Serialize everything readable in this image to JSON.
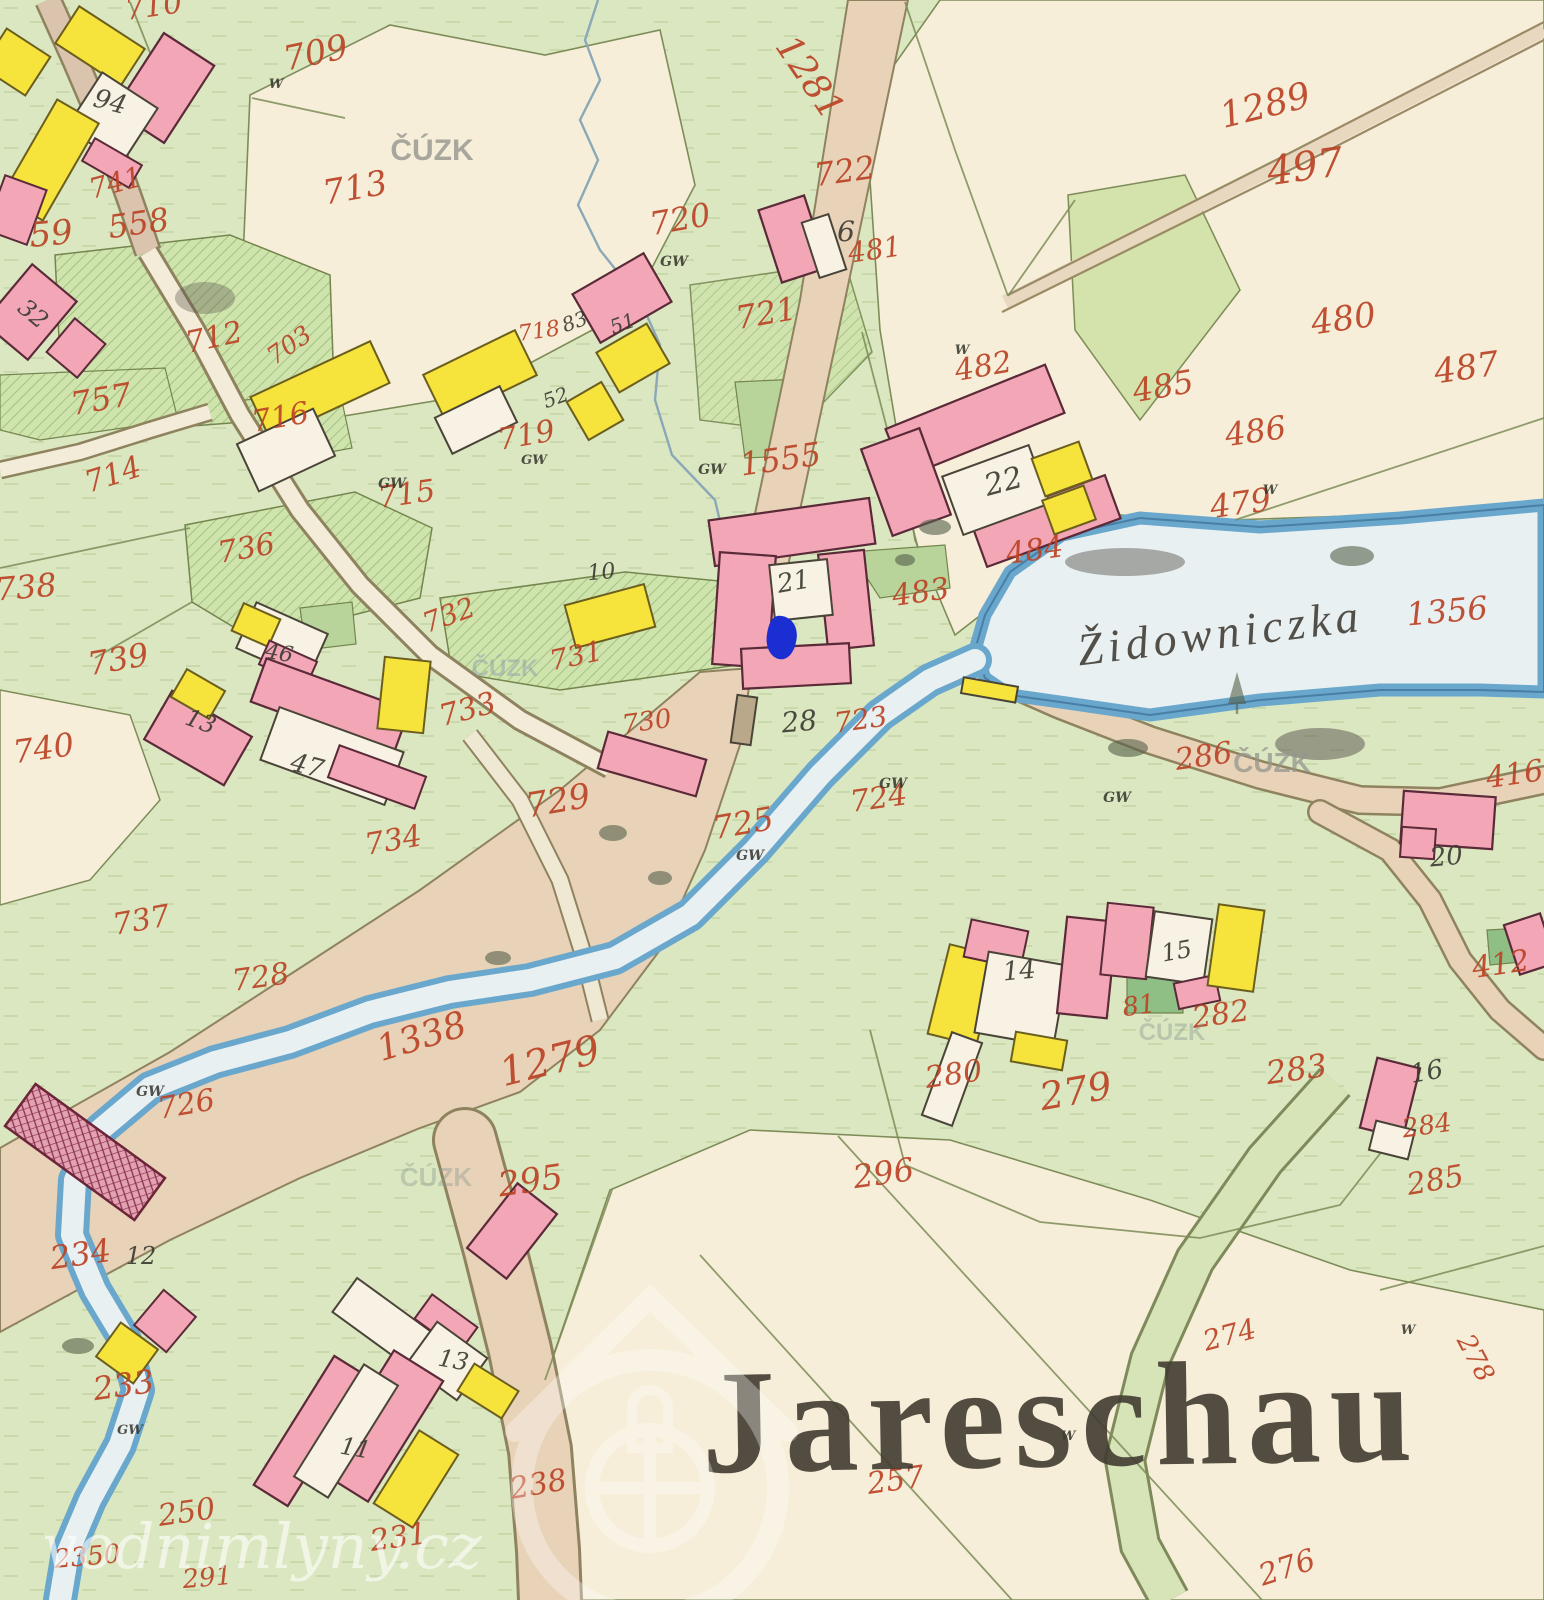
{
  "map": {
    "place_name": "Jareschau",
    "stream_name": "Židowniczka",
    "marker": {
      "x": 782,
      "y": 638,
      "color": "#1b2ed1"
    },
    "colors": {
      "meadow": "#dbe7c0",
      "field": "#f6eed8",
      "water_fill": "#e9f0f2",
      "water_edge": "#6aa7cc",
      "road": "#e8d2b8",
      "road_green": "#d6e4b8",
      "building_masonry": "#f2a6b6",
      "building_wood": "#f6e33c",
      "courtyard": "#f7f2e4",
      "parcel_number_ink": "#bb4527",
      "black_ink": "#3a3a30"
    },
    "labels": {
      "parcel_numbers": [
        {
          "t": "710",
          "x": 155,
          "y": 16,
          "s": 30,
          "r": -8
        },
        {
          "t": "709",
          "x": 318,
          "y": 64,
          "s": 34,
          "r": -12
        },
        {
          "t": "741",
          "x": 118,
          "y": 192,
          "s": 28,
          "r": -15
        },
        {
          "t": "713",
          "x": 357,
          "y": 199,
          "s": 34,
          "r": -10
        },
        {
          "t": "558",
          "x": 140,
          "y": 234,
          "s": 32,
          "r": -8
        },
        {
          "t": "59",
          "x": 52,
          "y": 245,
          "s": 34,
          "r": -5
        },
        {
          "t": "712",
          "x": 216,
          "y": 347,
          "s": 30,
          "r": -12
        },
        {
          "t": "703",
          "x": 294,
          "y": 352,
          "s": 25,
          "r": -35
        },
        {
          "t": "757",
          "x": 103,
          "y": 410,
          "s": 32,
          "r": -10
        },
        {
          "t": "716",
          "x": 282,
          "y": 427,
          "s": 30,
          "r": -10
        },
        {
          "t": "715",
          "x": 408,
          "y": 504,
          "s": 30,
          "r": -8
        },
        {
          "t": "714",
          "x": 116,
          "y": 484,
          "s": 30,
          "r": -18
        },
        {
          "t": "736",
          "x": 248,
          "y": 558,
          "s": 30,
          "r": -10
        },
        {
          "t": "738",
          "x": 27,
          "y": 598,
          "s": 32,
          "r": -5
        },
        {
          "t": "739",
          "x": 120,
          "y": 670,
          "s": 32,
          "r": -10
        },
        {
          "t": "740",
          "x": 45,
          "y": 759,
          "s": 32,
          "r": -8
        },
        {
          "t": "732",
          "x": 452,
          "y": 624,
          "s": 28,
          "r": -20
        },
        {
          "t": "731",
          "x": 578,
          "y": 665,
          "s": 28,
          "r": -12
        },
        {
          "t": "733",
          "x": 470,
          "y": 719,
          "s": 30,
          "r": -15
        },
        {
          "t": "730",
          "x": 648,
          "y": 730,
          "s": 26,
          "r": -8
        },
        {
          "t": "734",
          "x": 395,
          "y": 850,
          "s": 30,
          "r": -10
        },
        {
          "t": "729",
          "x": 560,
          "y": 812,
          "s": 34,
          "r": -10
        },
        {
          "t": "737",
          "x": 143,
          "y": 930,
          "s": 30,
          "r": -10
        },
        {
          "t": "728",
          "x": 262,
          "y": 987,
          "s": 30,
          "r": -8
        },
        {
          "t": "726",
          "x": 188,
          "y": 1114,
          "s": 30,
          "r": -10
        },
        {
          "t": "1338",
          "x": 425,
          "y": 1048,
          "s": 36,
          "r": -17
        },
        {
          "t": "1279",
          "x": 553,
          "y": 1074,
          "s": 40,
          "r": -14
        },
        {
          "t": "295",
          "x": 532,
          "y": 1192,
          "s": 34,
          "r": -8
        },
        {
          "t": "234",
          "x": 82,
          "y": 1265,
          "s": 32,
          "r": -8
        },
        {
          "t": "233",
          "x": 125,
          "y": 1396,
          "s": 32,
          "r": -8
        },
        {
          "t": "250",
          "x": 188,
          "y": 1522,
          "s": 30,
          "r": -8
        },
        {
          "t": "2350",
          "x": 88,
          "y": 1565,
          "s": 26,
          "r": -5
        },
        {
          "t": "291",
          "x": 208,
          "y": 1586,
          "s": 26,
          "r": -5
        },
        {
          "t": "231",
          "x": 400,
          "y": 1547,
          "s": 30,
          "r": -8
        },
        {
          "t": "238",
          "x": 540,
          "y": 1494,
          "s": 30,
          "r": -10
        },
        {
          "t": "718",
          "x": 540,
          "y": 338,
          "s": 22,
          "r": -8
        },
        {
          "t": "719",
          "x": 528,
          "y": 445,
          "s": 30,
          "r": -10
        },
        {
          "t": "720",
          "x": 682,
          "y": 230,
          "s": 32,
          "r": -10
        },
        {
          "t": "1281",
          "x": 800,
          "y": 84,
          "s": 36,
          "r": 56
        },
        {
          "t": "722",
          "x": 846,
          "y": 182,
          "s": 32,
          "r": -8
        },
        {
          "t": "481",
          "x": 876,
          "y": 259,
          "s": 28,
          "r": -8
        },
        {
          "t": "721",
          "x": 768,
          "y": 324,
          "s": 32,
          "r": -10
        },
        {
          "t": "1555",
          "x": 782,
          "y": 470,
          "s": 32,
          "r": -8
        },
        {
          "t": "482",
          "x": 985,
          "y": 376,
          "s": 30,
          "r": -10
        },
        {
          "t": "1289",
          "x": 1268,
          "y": 117,
          "s": 36,
          "r": -14
        },
        {
          "t": "497",
          "x": 1307,
          "y": 180,
          "s": 40,
          "r": -8
        },
        {
          "t": "480",
          "x": 1345,
          "y": 330,
          "s": 34,
          "r": -8
        },
        {
          "t": "485",
          "x": 1165,
          "y": 397,
          "s": 32,
          "r": -10
        },
        {
          "t": "487",
          "x": 1468,
          "y": 379,
          "s": 34,
          "r": -8
        },
        {
          "t": "486",
          "x": 1257,
          "y": 442,
          "s": 32,
          "r": -8
        },
        {
          "t": "479",
          "x": 1242,
          "y": 514,
          "s": 32,
          "r": -8
        },
        {
          "t": "1356",
          "x": 1448,
          "y": 622,
          "s": 32,
          "r": -5
        },
        {
          "t": "483",
          "x": 922,
          "y": 602,
          "s": 30,
          "r": -8
        },
        {
          "t": "484",
          "x": 1036,
          "y": 560,
          "s": 30,
          "r": -8
        },
        {
          "t": "723",
          "x": 862,
          "y": 729,
          "s": 28,
          "r": -8
        },
        {
          "t": "724",
          "x": 880,
          "y": 808,
          "s": 30,
          "r": -8
        },
        {
          "t": "725",
          "x": 745,
          "y": 834,
          "s": 32,
          "r": -10
        },
        {
          "t": "286",
          "x": 1205,
          "y": 766,
          "s": 30,
          "r": -8
        },
        {
          "t": "280",
          "x": 955,
          "y": 1084,
          "s": 30,
          "r": -8
        },
        {
          "t": "279",
          "x": 1078,
          "y": 1104,
          "s": 38,
          "r": -10
        },
        {
          "t": "81",
          "x": 1140,
          "y": 1014,
          "s": 26,
          "r": -8
        },
        {
          "t": "282",
          "x": 1222,
          "y": 1024,
          "s": 30,
          "r": -8
        },
        {
          "t": "283",
          "x": 1298,
          "y": 1080,
          "s": 32,
          "r": -8
        },
        {
          "t": "296",
          "x": 885,
          "y": 1184,
          "s": 32,
          "r": -8
        },
        {
          "t": "284",
          "x": 1428,
          "y": 1134,
          "s": 26,
          "r": -8
        },
        {
          "t": "285",
          "x": 1437,
          "y": 1190,
          "s": 30,
          "r": -10
        },
        {
          "t": "416",
          "x": 1516,
          "y": 784,
          "s": 30,
          "r": -8
        },
        {
          "t": "412",
          "x": 1502,
          "y": 974,
          "s": 30,
          "r": -8
        },
        {
          "t": "274",
          "x": 1232,
          "y": 1344,
          "s": 28,
          "r": -15
        },
        {
          "t": "278",
          "x": 1468,
          "y": 1362,
          "s": 26,
          "r": 62
        },
        {
          "t": "257",
          "x": 897,
          "y": 1490,
          "s": 30,
          "r": -8
        },
        {
          "t": "276",
          "x": 1290,
          "y": 1577,
          "s": 30,
          "r": -18
        }
      ],
      "building_numbers": [
        {
          "t": "94",
          "x": 108,
          "y": 110,
          "s": 26,
          "r": 15
        },
        {
          "t": "32",
          "x": 28,
          "y": 320,
          "s": 24,
          "r": 40
        },
        {
          "t": "83",
          "x": 577,
          "y": 328,
          "s": 20,
          "r": -20
        },
        {
          "t": "51",
          "x": 625,
          "y": 330,
          "s": 20,
          "r": -20
        },
        {
          "t": "52",
          "x": 558,
          "y": 404,
          "s": 20,
          "r": -20
        },
        {
          "t": "10",
          "x": 602,
          "y": 579,
          "s": 22,
          "r": -5
        },
        {
          "t": "46",
          "x": 278,
          "y": 660,
          "s": 22,
          "r": 10
        },
        {
          "t": "47",
          "x": 305,
          "y": 774,
          "s": 26,
          "r": 15
        },
        {
          "t": "13",
          "x": 198,
          "y": 729,
          "s": 24,
          "r": 20
        },
        {
          "t": "21",
          "x": 795,
          "y": 590,
          "s": 26,
          "r": -10
        },
        {
          "t": "22",
          "x": 1006,
          "y": 491,
          "s": 30,
          "r": -15
        },
        {
          "t": "6",
          "x": 846,
          "y": 241,
          "s": 28,
          "r": 0
        },
        {
          "t": "28",
          "x": 800,
          "y": 731,
          "s": 28,
          "r": -5
        },
        {
          "t": "12",
          "x": 141,
          "y": 1264,
          "s": 24,
          "r": 0
        },
        {
          "t": "11",
          "x": 354,
          "y": 1456,
          "s": 24,
          "r": 10
        },
        {
          "t": "13",
          "x": 452,
          "y": 1368,
          "s": 24,
          "r": 10
        },
        {
          "t": "14",
          "x": 1020,
          "y": 979,
          "s": 26,
          "r": -5
        },
        {
          "t": "15",
          "x": 1178,
          "y": 959,
          "s": 24,
          "r": -10
        },
        {
          "t": "16",
          "x": 1428,
          "y": 1080,
          "s": 26,
          "r": -10
        },
        {
          "t": "20",
          "x": 1447,
          "y": 865,
          "s": 26,
          "r": -5
        }
      ],
      "small_annotations": [
        {
          "t": "GW",
          "x": 392,
          "y": 488,
          "s": 14
        },
        {
          "t": "GW",
          "x": 674,
          "y": 266,
          "s": 14
        },
        {
          "t": "GW",
          "x": 712,
          "y": 474,
          "s": 14
        },
        {
          "t": "GW",
          "x": 534,
          "y": 464,
          "s": 13
        },
        {
          "t": "GW",
          "x": 150,
          "y": 1096,
          "s": 14
        },
        {
          "t": "GW",
          "x": 893,
          "y": 788,
          "s": 14
        },
        {
          "t": "GW",
          "x": 750,
          "y": 860,
          "s": 14
        },
        {
          "t": "GW",
          "x": 1117,
          "y": 802,
          "s": 14
        },
        {
          "t": "GW",
          "x": 130,
          "y": 1434,
          "s": 13
        },
        {
          "t": "W",
          "x": 962,
          "y": 354,
          "s": 13
        },
        {
          "t": "W",
          "x": 1270,
          "y": 494,
          "s": 13
        },
        {
          "t": "W",
          "x": 276,
          "y": 88,
          "s": 13
        },
        {
          "t": "W",
          "x": 1408,
          "y": 1334,
          "s": 13
        },
        {
          "t": "W",
          "x": 1068,
          "y": 1440,
          "s": 13
        }
      ],
      "watermarks": [
        {
          "t": "ČÚZK",
          "x": 432,
          "y": 160,
          "s": 30,
          "c": "#96968f",
          "o": 0.8
        },
        {
          "t": "ČÚZK",
          "x": 1272,
          "y": 772,
          "s": 28,
          "c": "#96968f",
          "o": 0.75
        },
        {
          "t": "ČÚZK",
          "x": 505,
          "y": 676,
          "s": 24,
          "c": "#8a9ab0",
          "o": 0.45
        },
        {
          "t": "ČÚZK",
          "x": 1172,
          "y": 1040,
          "s": 24,
          "c": "#8a9a90",
          "o": 0.42
        },
        {
          "t": "ČÚZK",
          "x": 436,
          "y": 1186,
          "s": 26,
          "c": "#8a9a90",
          "o": 0.4
        },
        {
          "t": "vodnimlyny.cz",
          "x": 262,
          "y": 1568,
          "s": 62,
          "c": "#ffffff",
          "o": 0.6
        }
      ]
    }
  }
}
